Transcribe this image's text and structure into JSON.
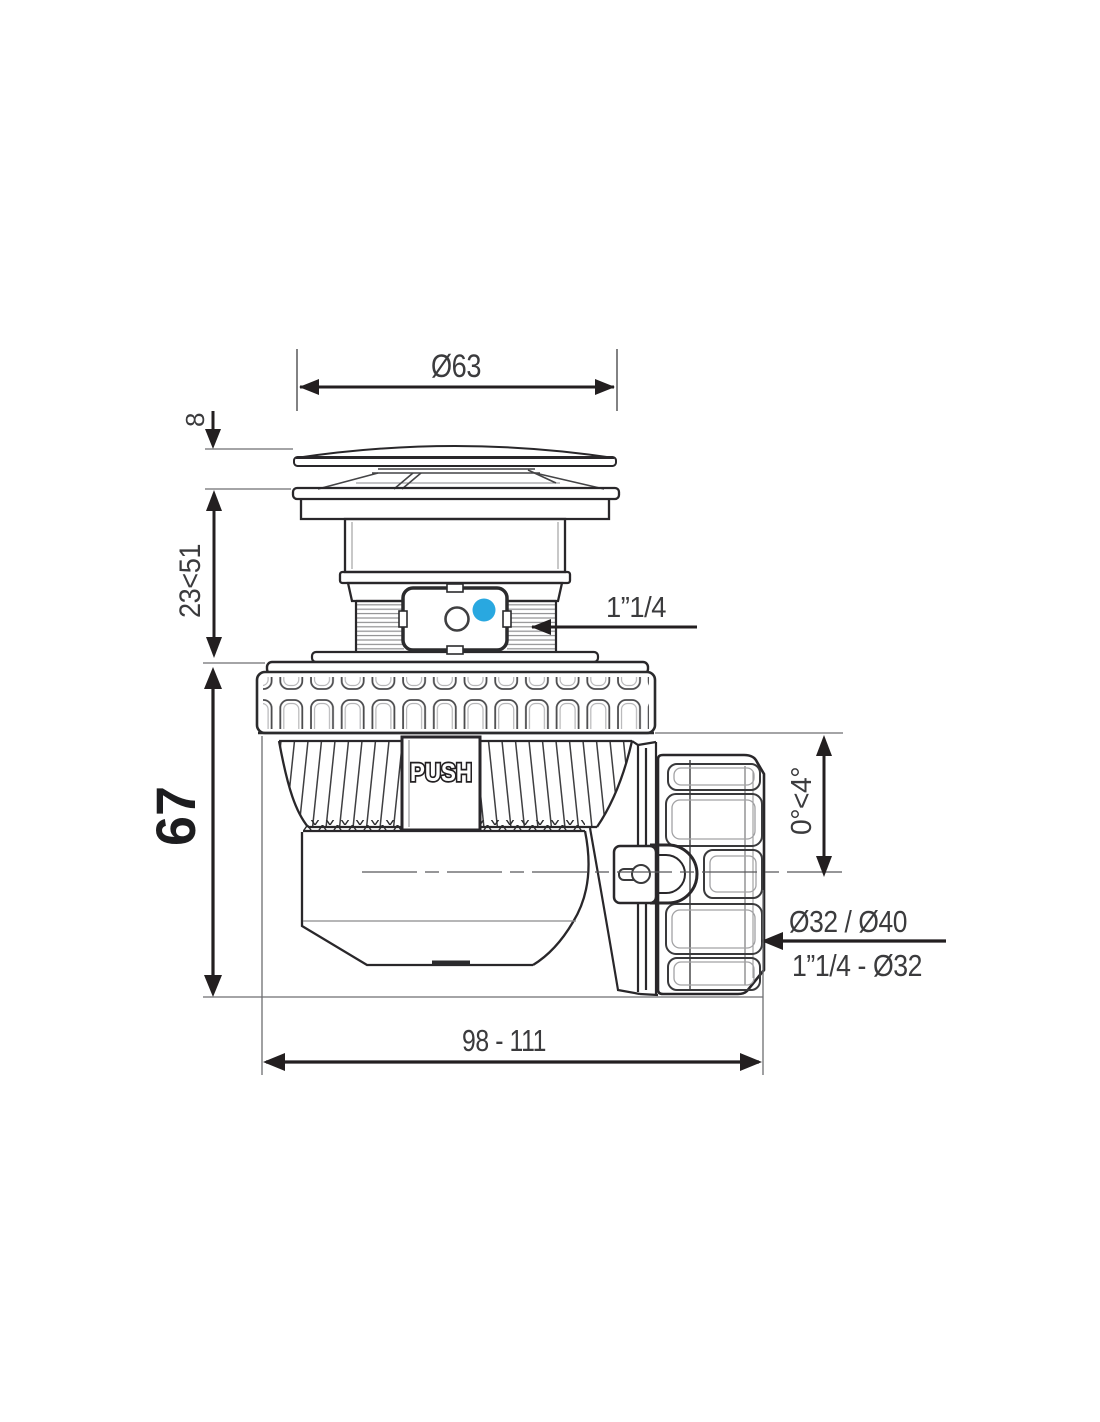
{
  "colors": {
    "line": "#231f20",
    "thin_line": "#6d6e71",
    "text": "#3b3b3d",
    "accent_blue": "#29a8e0"
  },
  "dimensions": {
    "cap_diameter": "Ø63",
    "cap_height": "8",
    "adjust_range": "23<51",
    "body_height": "67",
    "inlet_thread": "1”1/4",
    "outlet_angle": "0°<4°",
    "outlet_sizes_top": "Ø32 / Ø40",
    "outlet_sizes_bottom": "1”1/4 - Ø32",
    "overall_length": "98 - 111"
  },
  "labels": {
    "push_button": "PUSH"
  }
}
